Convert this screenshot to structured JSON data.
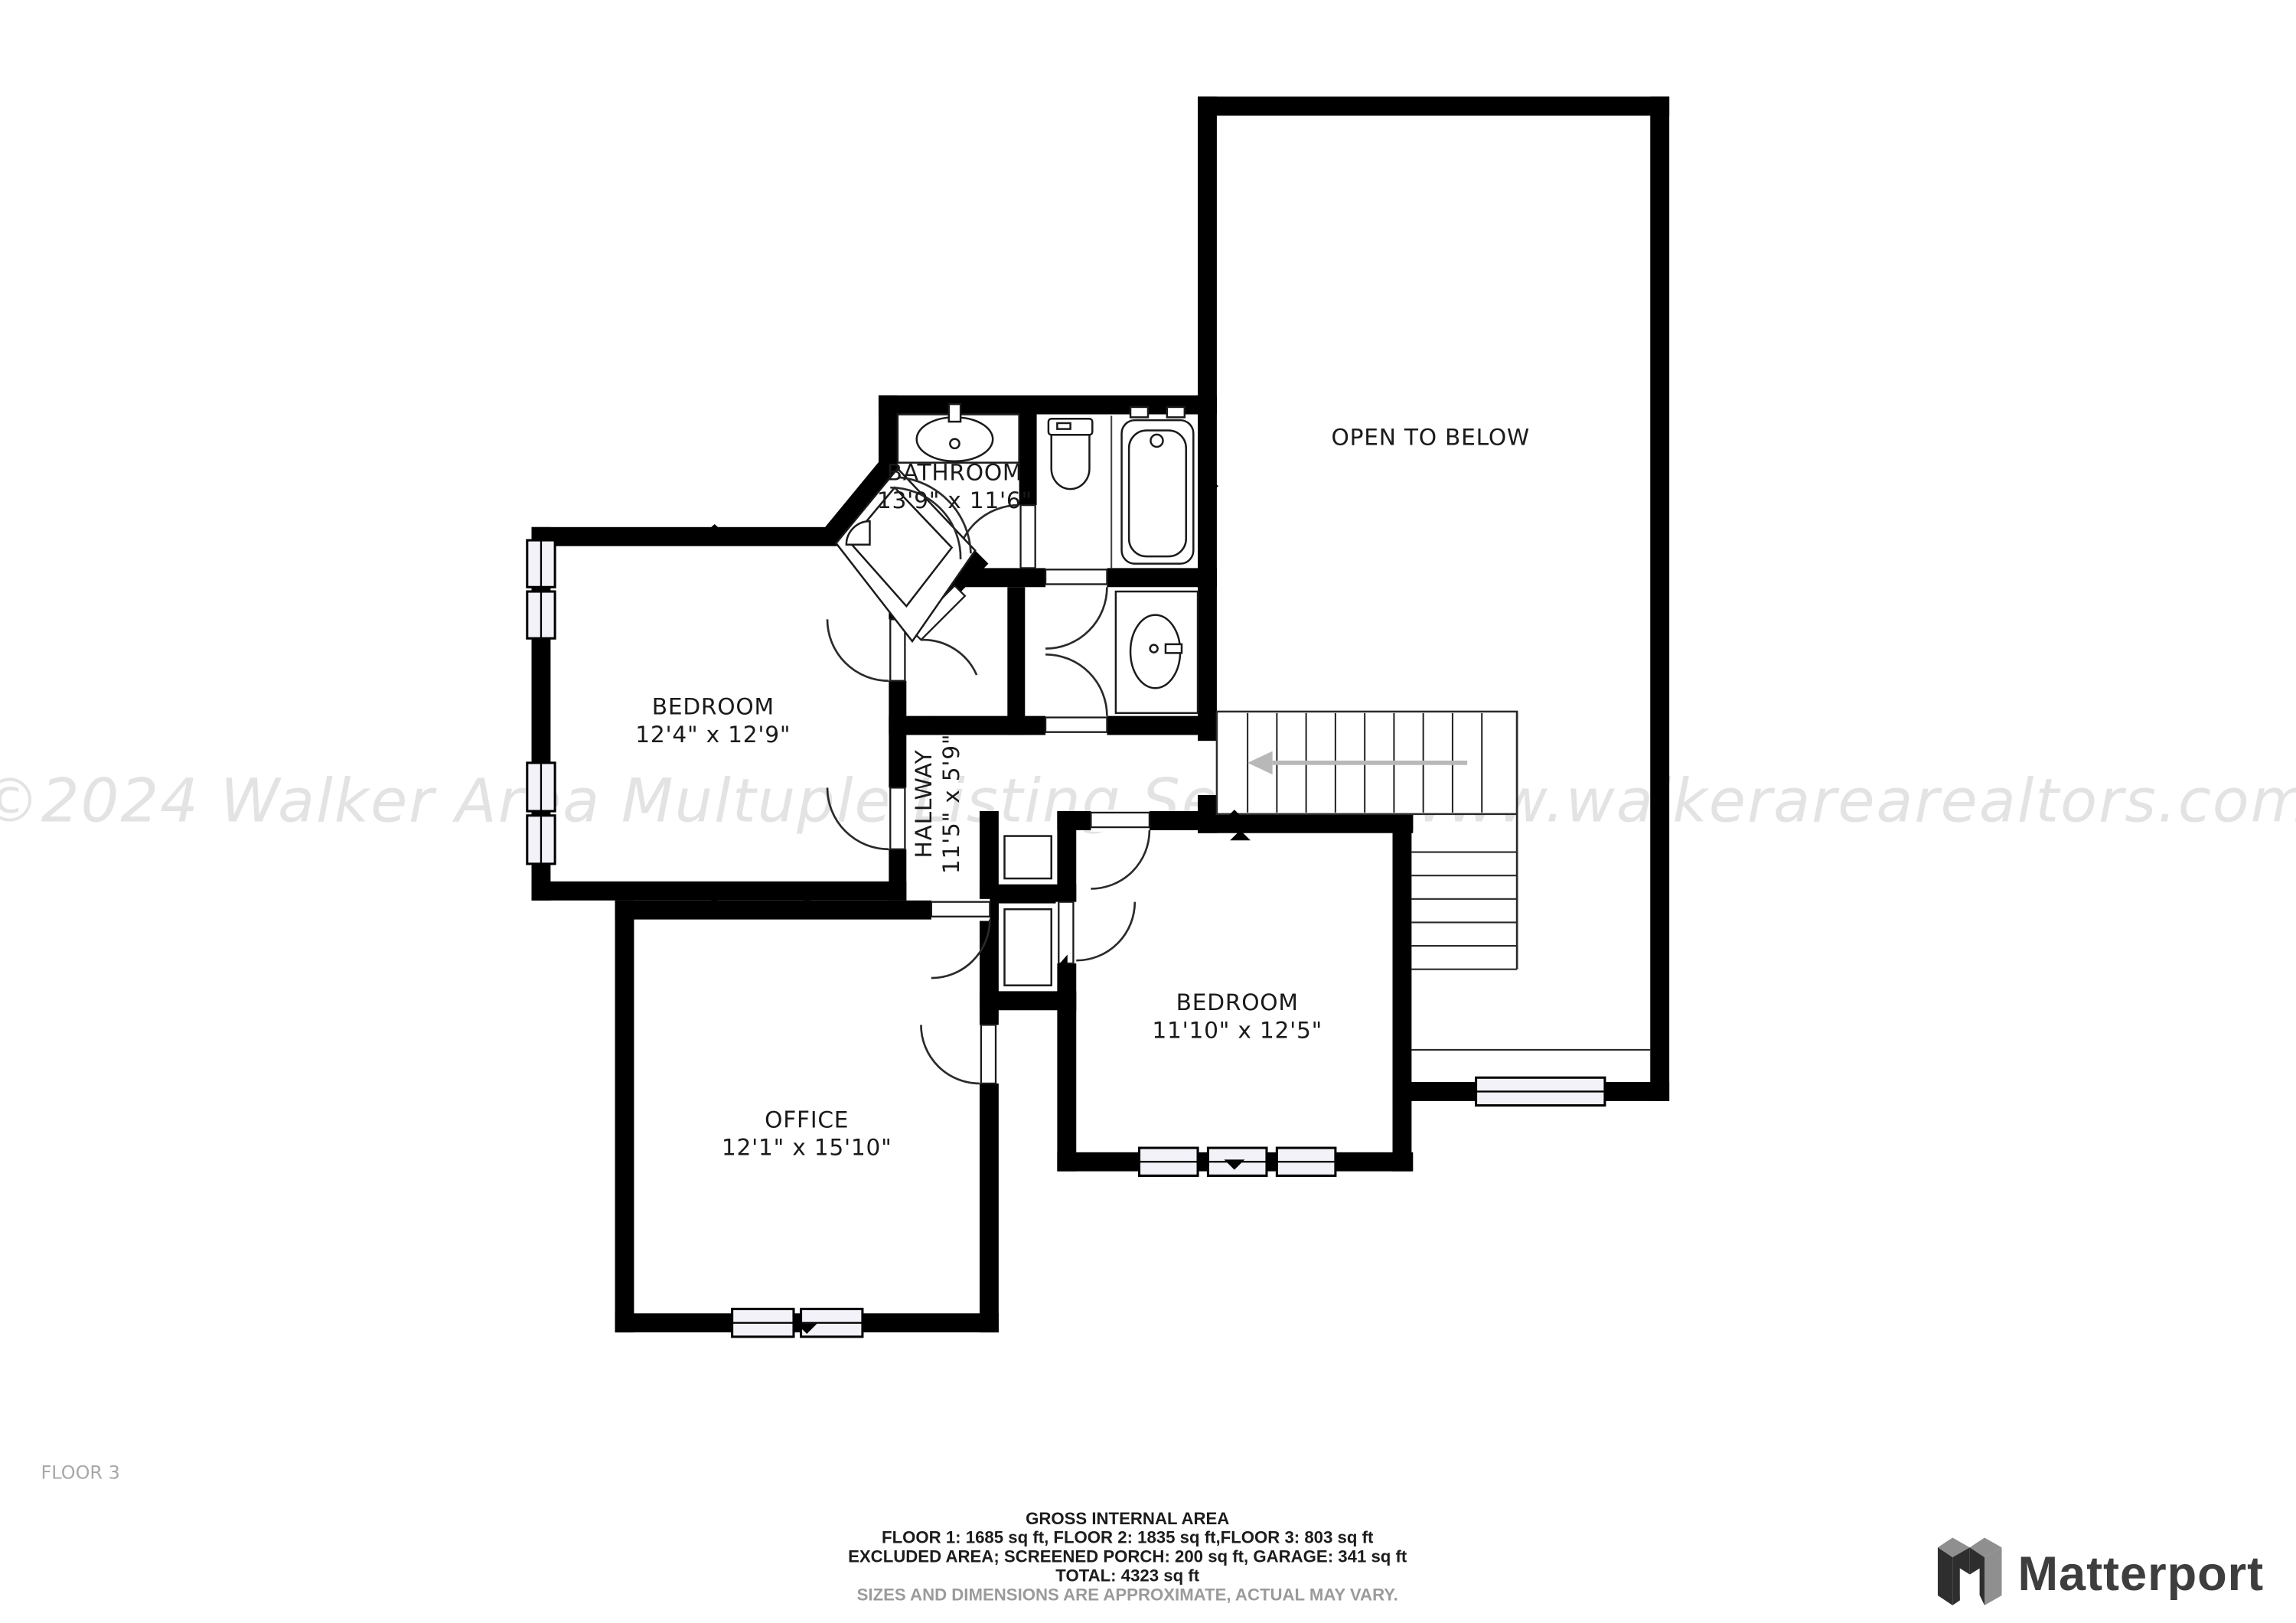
{
  "floor_plan": {
    "floor_label": "FLOOR 3",
    "watermark": "©2024 Walker Area Multuple Listing Service-www.walkerarearealtors.com",
    "rooms": [
      {
        "name": "BATHROOM",
        "dims": "13'9\" x 11'6\""
      },
      {
        "name": "BEDROOM",
        "dims": "12'4\" x 12'9\""
      },
      {
        "name": "HALLWAY",
        "dims": "11'5\" x 5'9\""
      },
      {
        "name": "BEDROOM",
        "dims": "11'10\" x 12'5\""
      },
      {
        "name": "OFFICE",
        "dims": "12'1\" x 15'10\""
      },
      {
        "name": "OPEN TO BELOW",
        "dims": ""
      }
    ]
  },
  "footer": {
    "title": "GROSS INTERNAL AREA",
    "line1": "FLOOR 1: 1685 sq ft, FLOOR 2: 1835 sq ft,FLOOR 3: 803 sq ft",
    "line2": "EXCLUDED AREA; SCREENED PORCH: 200 sq ft, GARAGE: 341 sq ft",
    "line3": "TOTAL: 4323 sq ft",
    "disclaimer": "SIZES AND DIMENSIONS ARE APPROXIMATE, ACTUAL MAY VARY."
  },
  "brand": {
    "name": "Matterport"
  },
  "colors": {
    "wall": "#000000",
    "watermark": "#e3e3e3",
    "muted_text": "#9b9b9b",
    "brand_text": "#3e3e3e"
  }
}
